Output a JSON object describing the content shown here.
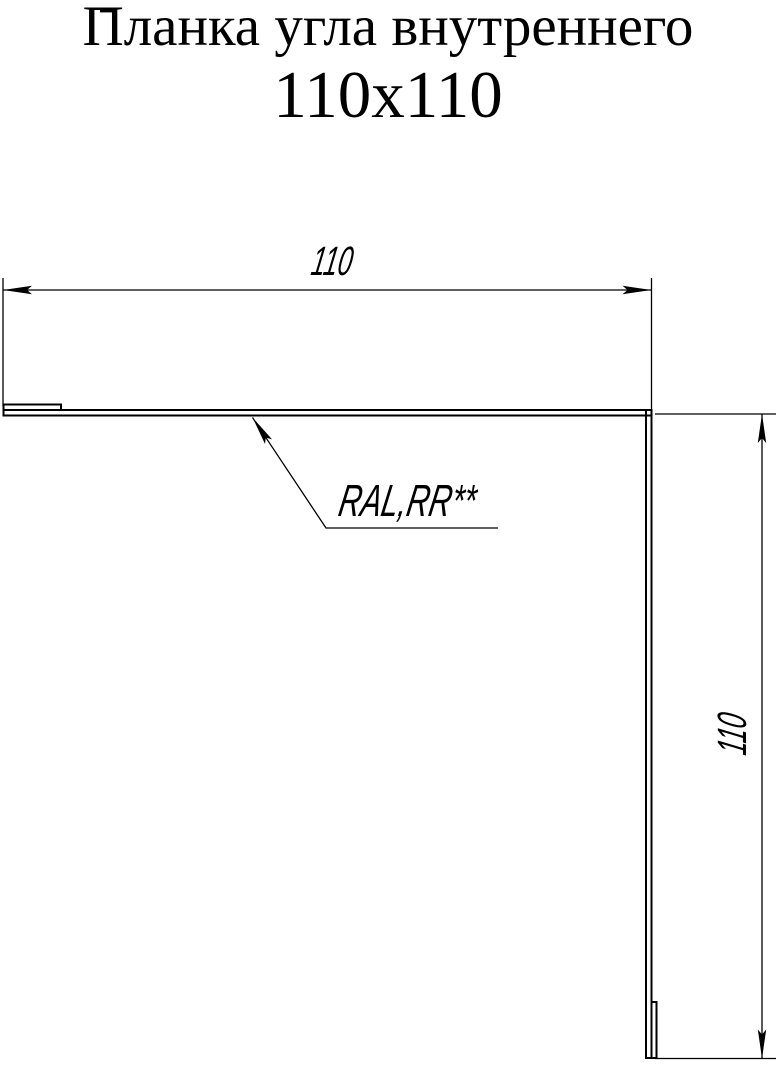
{
  "page": {
    "background": "#ffffff",
    "line_color": "#000000"
  },
  "title": {
    "line1": "Планка угла внутреннего",
    "line2": "110x110"
  },
  "drawing": {
    "type": "technical-profile-drawing",
    "part_name": "Планка угла внутреннего 110x110",
    "dimensions": {
      "top": {
        "value": "110"
      },
      "right": {
        "value": "110"
      }
    },
    "material_label": {
      "text": "RAL,RR**"
    }
  }
}
